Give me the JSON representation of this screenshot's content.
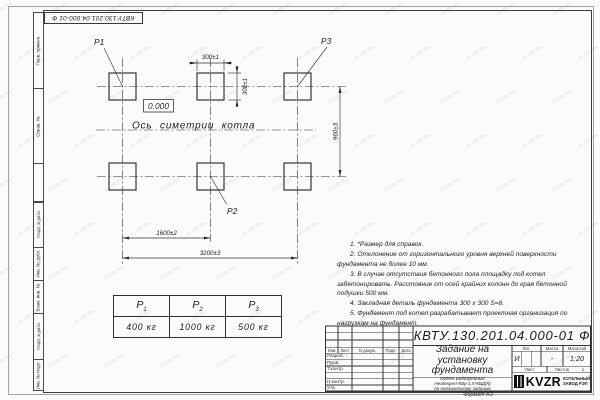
{
  "watermark": "KVZR.RU",
  "margin": {
    "doc_number_top": "КВТУ.130.201.04.000-01 Ф",
    "labels_top": [
      "Перв. примен.",
      "Справ. №"
    ],
    "labels_bottom": [
      "Подп. и дата",
      "Инв. № дубл.",
      "Взам. инв. №",
      "Подп. и дата",
      "Инв. № подл."
    ]
  },
  "drawing": {
    "p1": "Р1",
    "p2": "Р2",
    "p3": "Р3",
    "elevation": "0.000",
    "axis_label": "Ось симетрии котла",
    "dim_300_h": "300±1",
    "dim_300_v": "300±1",
    "dim_960": "960±3",
    "dim_1600": "1600±2",
    "dim_3200": "3200±3"
  },
  "notes": [
    "1. *Размер для справок.",
    "2. Отклонение от горизонтального уровня верхней поверхности фундамента не более 10 мм.",
    "3. В случае отсутствия бетонного пола площадку под котел забетонировать. Расстояние от осей крайних колонн до края бетонной подушки 500 мм.",
    "4. Закладная деталь фундамента 300 х 300 S=8.",
    "5. Фундамент под котел разрабатывает проектная организация по нагрузкам на фундамент."
  ],
  "load_table": {
    "headers": [
      {
        "sym": "Р",
        "sub": "1"
      },
      {
        "sym": "Р",
        "sub": "2"
      },
      {
        "sym": "Р",
        "sub": "3"
      }
    ],
    "values": [
      "400 кг",
      "1000 кг",
      "500 кг"
    ]
  },
  "title_block": {
    "doc_number": "КВТУ.130.201.04.000-01 Ф",
    "title_lines": [
      "Задание на",
      "установку",
      "фундамента"
    ],
    "subtitle_lines": [
      "Котел Водогрейный",
      "Heatexpert-КВр-1,5-КБД(К)",
      "по техническому заданию"
    ],
    "col_headers": [
      "Изм",
      "Лист",
      "N докум.",
      "Подп.",
      "Дата"
    ],
    "row_labels": [
      "Разраб.",
      "Пров.",
      "Т.контр.",
      "",
      "Н.контр.",
      "Утв."
    ],
    "lit_header": "Лит.",
    "mass_header": "Масса",
    "scale_header": "Масштаб",
    "lit_value": "И",
    "mass_value": "-",
    "scale_value": "1:20",
    "sheet_label": "Лист",
    "sheets_label": "Листов",
    "sheets_value": "1",
    "logo_text": "KVZR",
    "company_lines": [
      "КОТЕЛЬНЫЙ",
      "ЗАВОД РЭП"
    ]
  },
  "format_label": "Формат А3"
}
